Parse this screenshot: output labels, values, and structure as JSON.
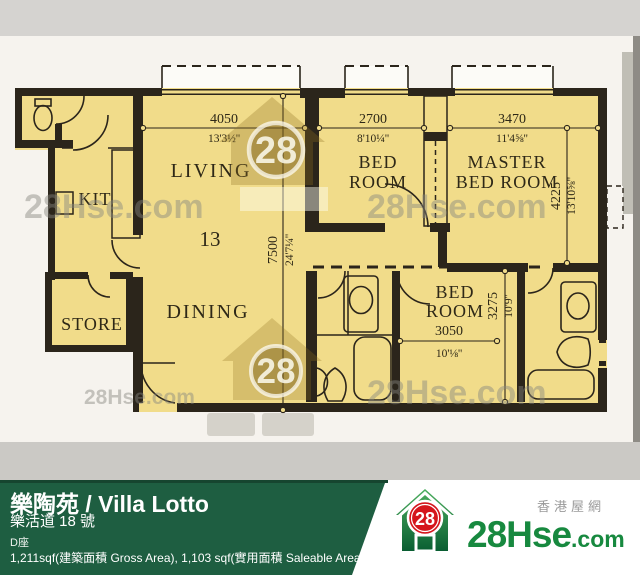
{
  "plan": {
    "rooms": {
      "kit": "KIT",
      "living": "LIVING",
      "dining": "DINING",
      "store": "STORE",
      "bed1_l1": "BED",
      "bed1_l2": "ROOM",
      "master_l1": "MASTER",
      "master_l2": "BED ROOM",
      "bed2_l1": "BED",
      "bed2_l2": "ROOM",
      "unit": "13"
    },
    "dims": {
      "living_w": {
        "mm": "4050",
        "ft": "13'3½''"
      },
      "bed1_w": {
        "mm": "2700",
        "ft": "8'10¼''"
      },
      "master_w": {
        "mm": "3470",
        "ft": "11'4⅝''"
      },
      "living_d": {
        "mm": "7500",
        "ft": "24'7¼''"
      },
      "master_d": {
        "mm": "4225",
        "ft": "13'10⅝''"
      },
      "bed2_d": {
        "mm": "3275",
        "ft": "10'9''"
      },
      "bed2_w": {
        "mm": "3050",
        "ft": "10'⅛''"
      }
    },
    "watermark": {
      "text": "28Hse.com",
      "badge": "28"
    }
  },
  "footer": {
    "title": "樂陶苑 / Villa Lotto",
    "address": "樂活道 18 號",
    "block": "D座",
    "area": "1,211sqf(建築面積 Gross Area), 1,103 sqf(實用面積 Saleable Area)",
    "site_cn": "香港屋網",
    "brand": {
      "badge": "28",
      "name": "28Hse",
      "tld": ".com"
    }
  },
  "colors": {
    "green_bar": "#1e5e41",
    "green_bar_edge": "#16452f",
    "logo_green": "#17893f",
    "badge_red": "#d5151c",
    "plan_yellow": "#f1dc8a",
    "wall": "#2b251b"
  }
}
